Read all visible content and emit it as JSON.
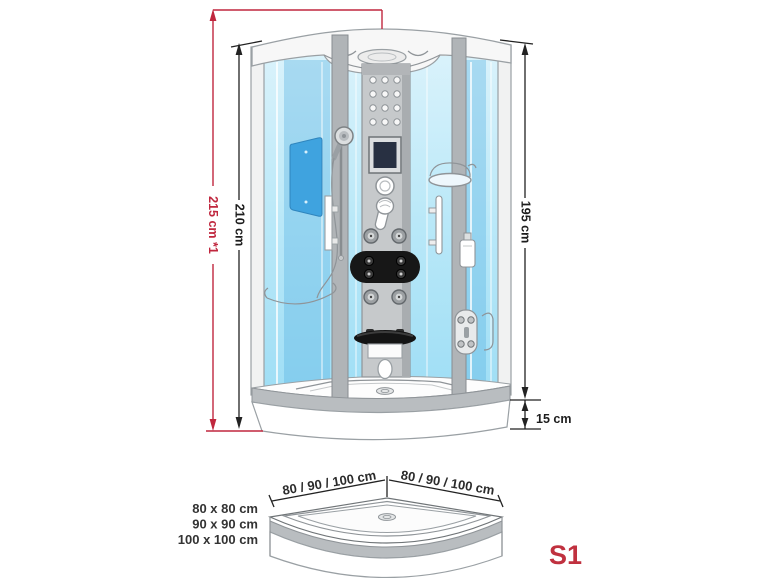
{
  "model": {
    "label": "S1",
    "color": "#c0313f"
  },
  "front_view": {
    "total_height_label": "215 cm *1",
    "cabin_height_label": "210 cm",
    "glass_height_label": "195 cm",
    "tray_height_label": "15 cm"
  },
  "tray_view": {
    "left_width_label": "80 / 90 / 100 cm",
    "right_width_label": "80 / 90 / 100 cm",
    "size_options": [
      "80 x 80 cm",
      "90 x 90 cm",
      "100 x 100 cm"
    ]
  },
  "colors": {
    "accent_red": "#c0273e",
    "glass_blue": "#aee3f6",
    "deep_glass_blue": "#5ab4e4",
    "frame_gray": "#9ba0a4",
    "column_gray": "#c6c9cb",
    "black_fitting": "#171717"
  }
}
